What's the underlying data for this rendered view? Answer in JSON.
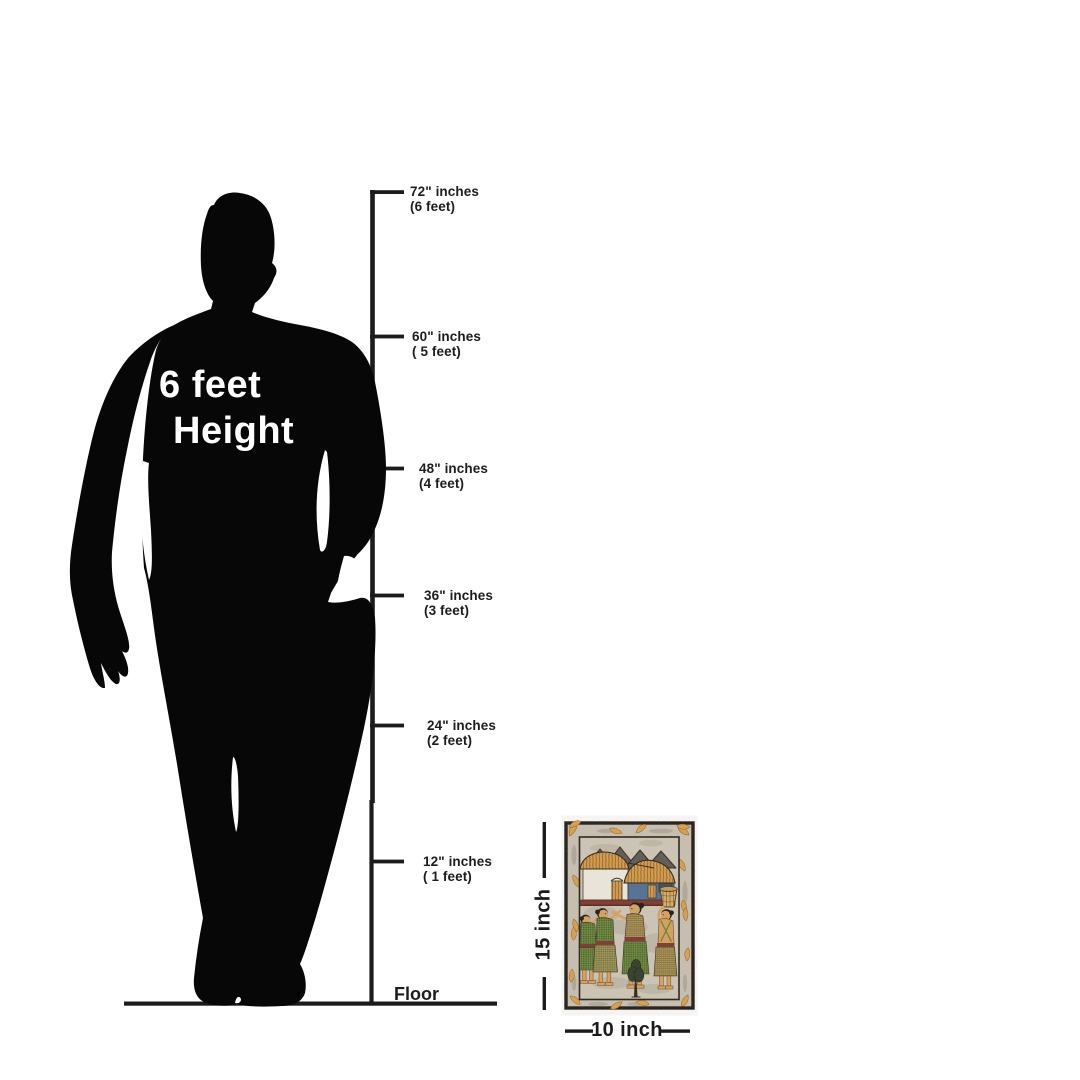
{
  "page": {
    "background_color": "#ffffff",
    "description": "Size guide diagram comparing a 6 feet tall person silhouette to a 15 x 10 inch folk painting against an inch scale"
  },
  "person": {
    "label_line1": "6 feet",
    "label_line2": "Height",
    "silhouette_color": "#070707",
    "label_color": "#ffffff"
  },
  "scale": {
    "line_color": "#1c1c1c",
    "marks": [
      {
        "inches": "72\" inches",
        "feet": "(6 feet)"
      },
      {
        "inches": "60\" inches",
        "feet": "( 5 feet)"
      },
      {
        "inches": "48\" inches",
        "feet": "(4 feet)"
      },
      {
        "inches": "36\" inches",
        "feet": "(3 feet)"
      },
      {
        "inches": "24\" inches",
        "feet": "(2 feet)"
      },
      {
        "inches": "12\" inches",
        "feet": "( 1 feet)"
      }
    ],
    "floor_label": "Floor"
  },
  "artwork": {
    "height_label": "15 inch",
    "width_label": "10 inch",
    "description": "folk painting of a village scene: mountains, two thatched huts, basket, four villagers and a tree inside a decorated border",
    "palette": {
      "margin_beige": "#c9c1b2",
      "ochre_orange": "#dd9f45",
      "mountain_gray": "#57554e",
      "wall_white": "#f0ece1",
      "wall_blue": "#4a6c92",
      "maroon": "#7c2f26",
      "skin_tan": "#dba15a",
      "leaf_green": "#5e7c31",
      "khaki": "#b49d58",
      "ink_black": "#1b1712"
    }
  }
}
